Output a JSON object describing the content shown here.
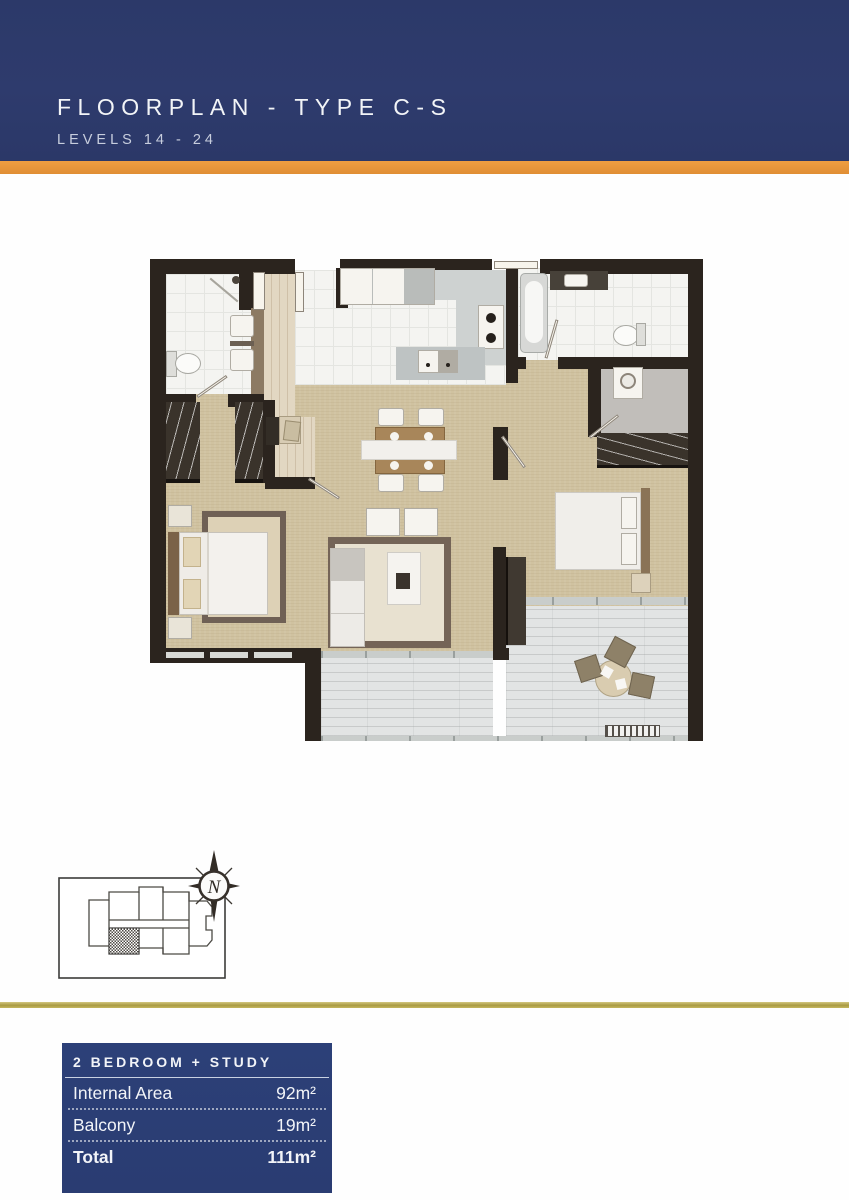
{
  "header": {
    "title": "FLOORPLAN - TYPE C-S",
    "subtitle": "LEVELS 14 - 24"
  },
  "colors": {
    "header_navy": "#2d3a6c",
    "accent_orange": "#e8973b",
    "gold_rule": "#ac9d45",
    "table_navy": "#2b3e76",
    "floor_tan": "#d0c2a0",
    "wall_dark": "#2b241e"
  },
  "keyplan": {
    "north_label": "N"
  },
  "summary_table": {
    "header": "2 BEDROOM + STUDY",
    "rows": [
      {
        "label": "Internal Area",
        "value": "92m²"
      },
      {
        "label": "Balcony",
        "value": "19m²"
      },
      {
        "label": "Total",
        "value": "111m²"
      }
    ]
  }
}
